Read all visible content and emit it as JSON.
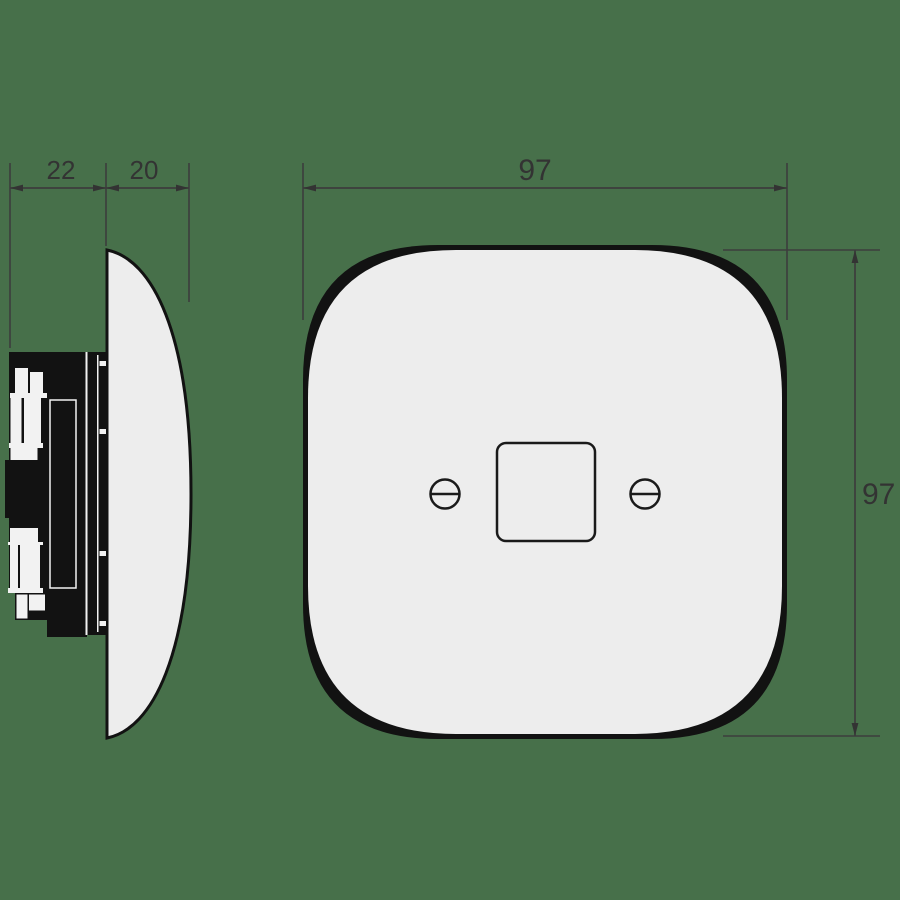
{
  "colors": {
    "background": "#47704a",
    "plate-fill": "#ededed",
    "ink": "#121212",
    "cutout": "#f2f2f2",
    "dim-line": "#3d3d3d",
    "dim-text": "#333333"
  },
  "views": {
    "side": {
      "dim_mechanism_depth": "22",
      "dim_plate_depth": "20"
    },
    "front": {
      "dim_width": "97",
      "dim_height": "97"
    }
  }
}
